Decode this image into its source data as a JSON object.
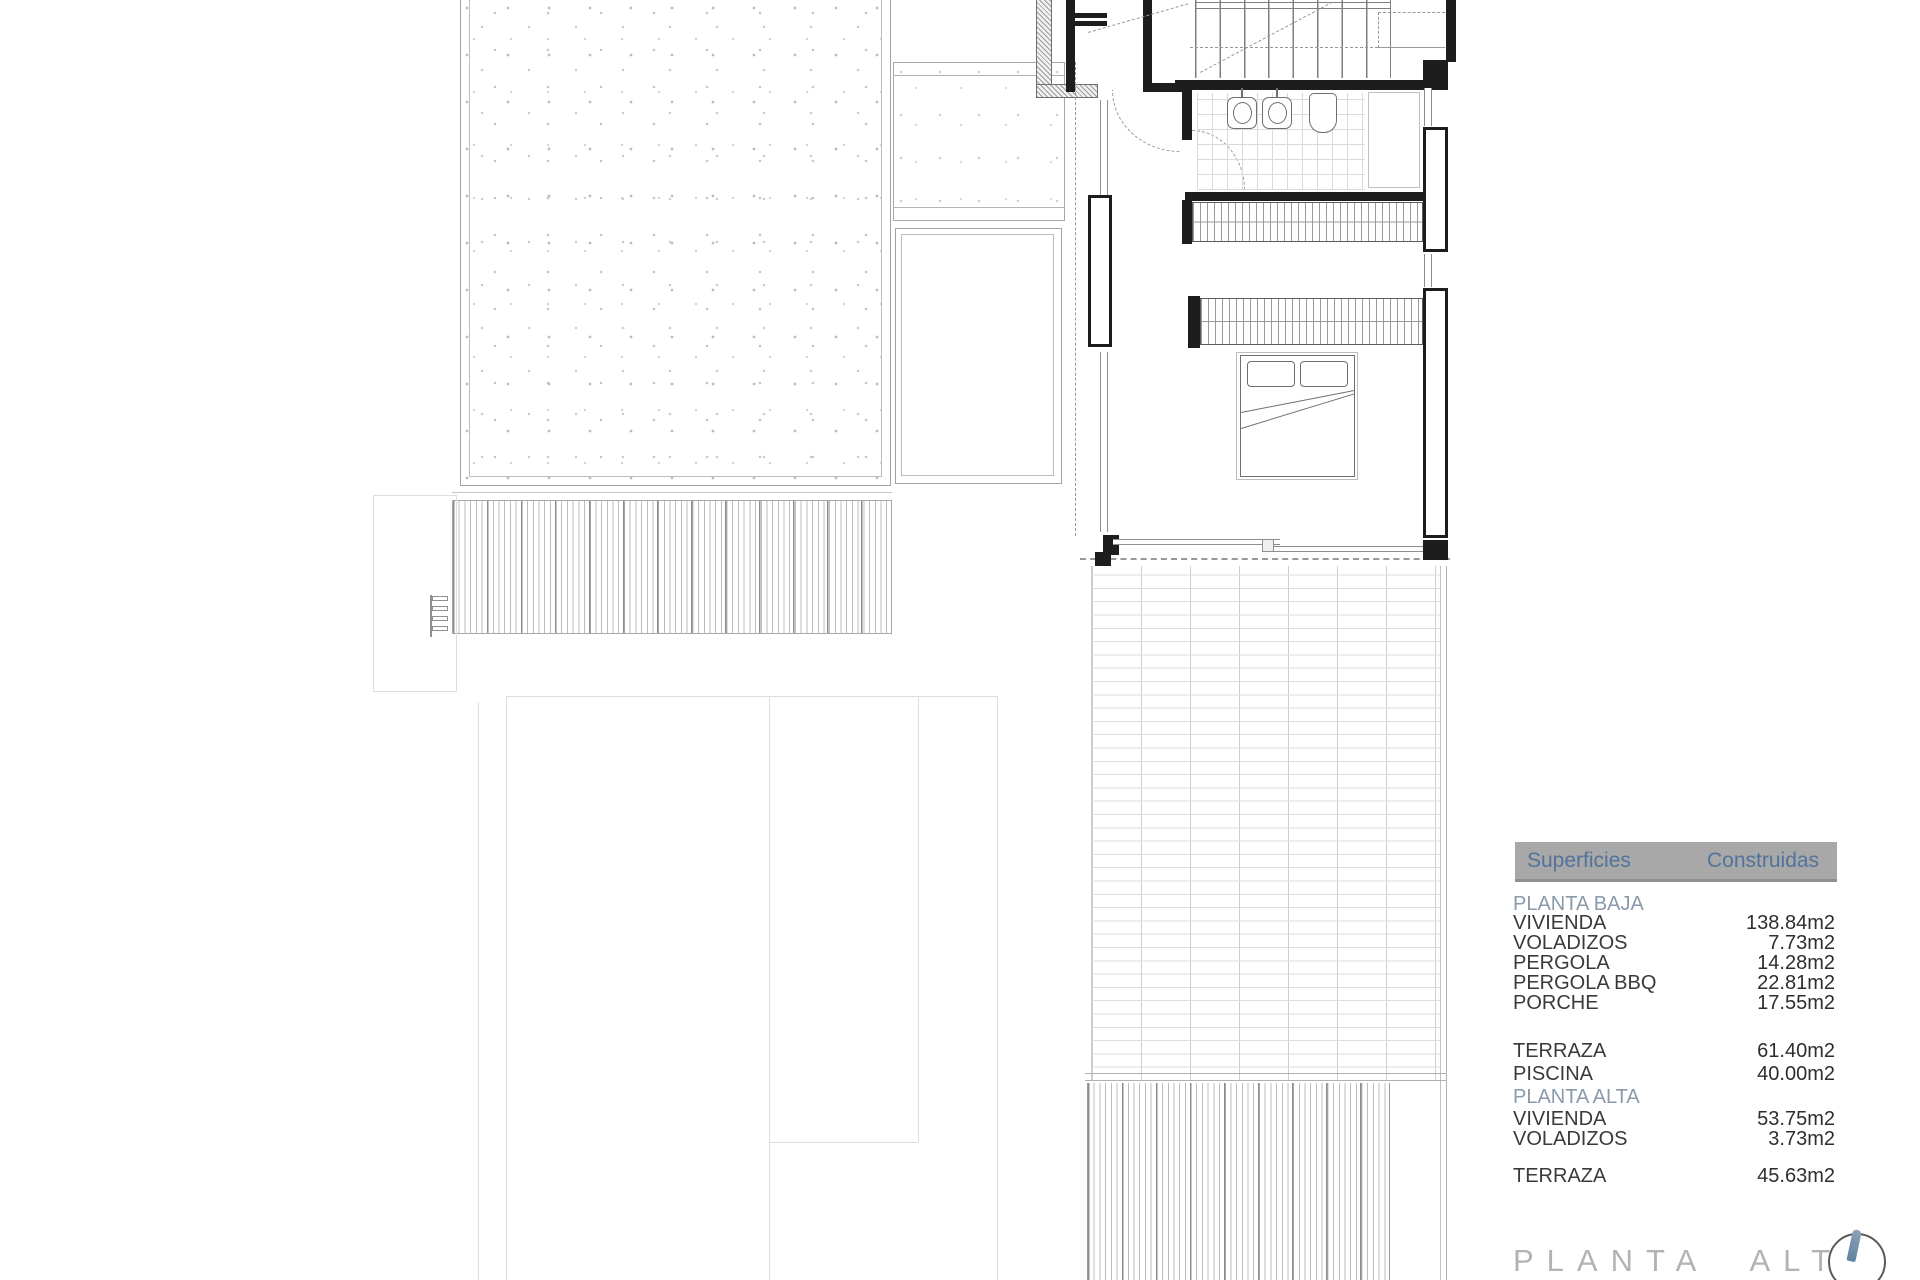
{
  "drawing": {
    "title": "PLANTA ALTA",
    "compass_icon": "north-arrow-icon",
    "rooms": {
      "fixtures": [
        "stairs",
        "bathroom-sinks",
        "toilet",
        "shower",
        "wardrobes",
        "double-bed",
        "sliding-glass-door",
        "tiled-terrace",
        "timber-deck",
        "pergola-slats",
        "gravel-roof",
        "pool-ladder"
      ]
    }
  },
  "surfaces_table": {
    "header": {
      "col1": "Superficies",
      "col2": "Construidas"
    },
    "rows": [
      {
        "label": "PLANTA BAJA",
        "value": "",
        "type": "section"
      },
      {
        "label": "VIVIENDA",
        "value": "138.84m2"
      },
      {
        "label": "VOLADIZOS",
        "value": "7.73m2"
      },
      {
        "label": "PERGOLA",
        "value": "14.28m2"
      },
      {
        "label": "PERGOLA BBQ",
        "value": "22.81m2"
      },
      {
        "label": "PORCHE",
        "value": "17.55m2"
      },
      {
        "label": "TERRAZA",
        "value": "61.40m2"
      },
      {
        "label": "PISCINA",
        "value": "40.00m2"
      },
      {
        "label": "PLANTA ALTA",
        "value": "",
        "type": "section"
      },
      {
        "label": "VIVIENDA",
        "value": "53.75m2"
      },
      {
        "label": "VOLADIZOS",
        "value": "3.73m2"
      },
      {
        "label": "TERRAZA",
        "value": "45.63m2"
      }
    ],
    "colors": {
      "header_bg": "#a8a8a8",
      "header_text": "#51739b",
      "section_text": "#8a9aab",
      "row_text": "#3a3a3a",
      "compass_needle": "#6d8ca3"
    }
  }
}
